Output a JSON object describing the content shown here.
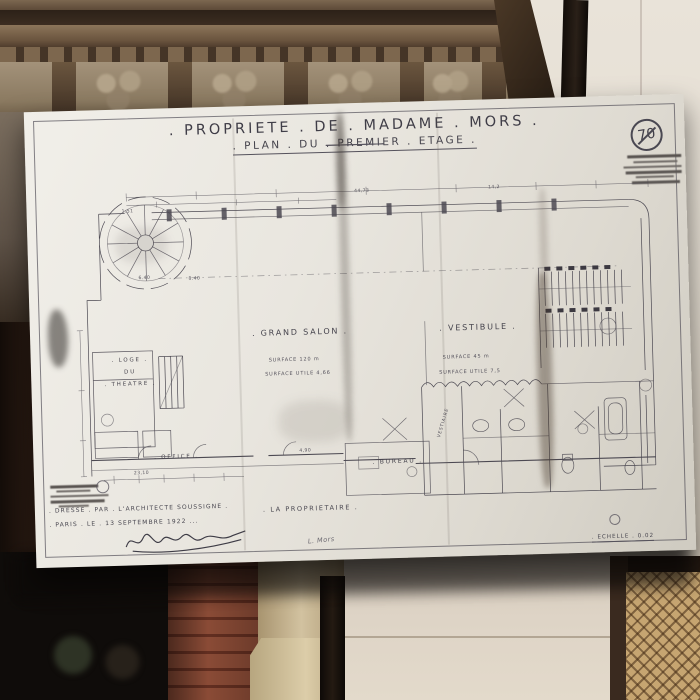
{
  "photo_scene": {
    "colors": {
      "sheet": "#e9e7e0",
      "ink": "#45434c",
      "wall": "#e5ded2",
      "mantel_wood": "#6e5a45",
      "brick": "#8a4b36",
      "stone_column": "#c9b791",
      "panel_wall": "#ddd3c4",
      "wicker": "#c6a571",
      "fireplace_dark": "#0f0c0a"
    }
  },
  "plan": {
    "title": ". PROPRIETE . DE . MADAME . MORS .",
    "subtitle": ". PLAN . DU . PREMIER . ETAGE .",
    "stamp_number": "70",
    "rooms": {
      "grand_salon": ". GRAND SALON .",
      "grand_salon_surface": "SURFACE 120 m",
      "grand_salon_surface_utile": "SURFACE UTILE 4,66",
      "vestibule": ". VESTIBULE .",
      "vestibule_surface": "SURFACE 45 m",
      "vestibule_surface_utile": "SURFACE UTILE 7,5",
      "loge_1": ". LOGE .",
      "loge_2": "DU",
      "loge_3": ". THEATRE .",
      "office": ". OFFICE .",
      "bureau": ". BUREAU .",
      "vestiaire": "VESTIAIRE"
    },
    "dimensions": [
      "44,73",
      "1.51",
      "6.40",
      "8.40",
      "14,2",
      "4,90",
      "23,10"
    ],
    "footer": {
      "dresse": ". DRESSE . PAR . L'ARCHITECTE SOUSSIGNE .",
      "paris": ". PARIS . LE . 13 SEPTEMBRE 1922 ...",
      "proprietaire": ". LA PROPRIETAIRE .",
      "annotation": "L. Mors",
      "echelle": ". ECHELLE . 0.02"
    }
  }
}
